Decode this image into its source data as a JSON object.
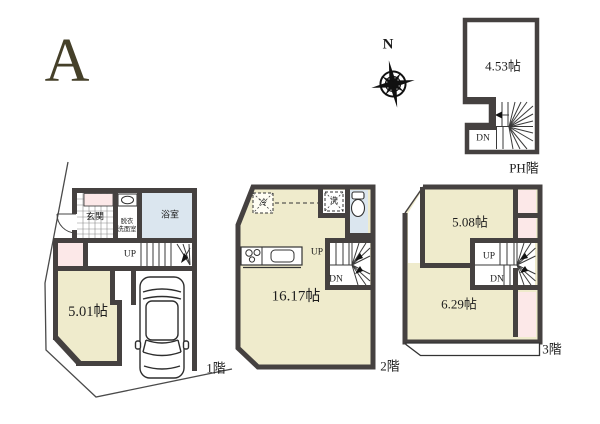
{
  "page": {
    "plan_label": "A"
  },
  "compass": {
    "north_label": "N"
  },
  "colors": {
    "room_cream": "#efebcc",
    "accent_pink": "#fce8e8",
    "water_blue": "#dbe6ef",
    "wall_gray": "#454140",
    "plan_letter": "#454029"
  },
  "floor1": {
    "floor_label": "1階",
    "entrance": "玄関",
    "dressing_room_line1": "脱衣",
    "dressing_room_line2": "洗面室",
    "bathroom": "浴室",
    "room_size": "5.01帖",
    "stairs_up": "UP"
  },
  "floor2": {
    "floor_label": "2階",
    "room_size": "16.17帖",
    "refrigerator": "冷",
    "washer": "洗",
    "stairs_up": "UP",
    "stairs_down": "DN"
  },
  "floor3": {
    "floor_label": "3階",
    "room_a_size": "5.08帖",
    "room_b_size": "6.29帖",
    "stairs_up": "UP",
    "stairs_down": "DN"
  },
  "ph_floor": {
    "floor_label": "PH階",
    "room_size": "4.53帖",
    "stairs_down": "DN"
  }
}
